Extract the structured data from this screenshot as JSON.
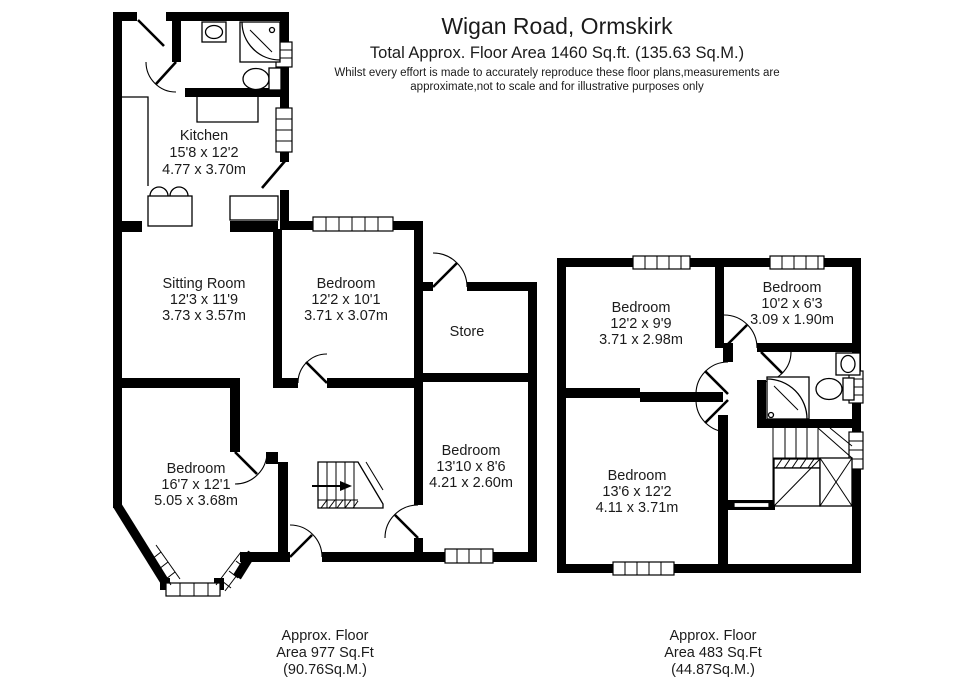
{
  "header": {
    "title": "Wigan Road, Ormskirk",
    "subtitle": "Total Approx. Floor Area 1460 Sq.ft. (135.63 Sq.M.)",
    "disclaimer_line1": "Whilst every effort is made to accurately reproduce these floor plans,measurements are",
    "disclaimer_line2": "approximate,not to scale and for illustrative purposes only"
  },
  "ground_floor": {
    "rooms": {
      "kitchen": {
        "name": "Kitchen",
        "imperial": "15'8 x 12'2",
        "metric": "4.77 x 3.70m"
      },
      "sitting_room": {
        "name": "Sitting Room",
        "imperial": "12'3 x 11'9",
        "metric": "3.73 x 3.57m"
      },
      "bedroom1": {
        "name": "Bedroom",
        "imperial": "12'2 x 10'1",
        "metric": "3.71 x 3.07m"
      },
      "store": {
        "name": "Store"
      },
      "bedroom2": {
        "name": "Bedroom",
        "imperial": "16'7 x 12'1",
        "metric": "5.05 x 3.68m"
      },
      "bedroom3": {
        "name": "Bedroom",
        "imperial": "13'10 x 8'6",
        "metric": "4.21 x 2.60m"
      }
    },
    "fixtures": [
      "wash-basin",
      "shower",
      "toilet",
      "kitchen-sink",
      "staircase-with-up-arrow",
      "bay-window"
    ],
    "area_label": {
      "line1": "Approx. Floor",
      "line2": "Area 977 Sq.Ft",
      "line3": "(90.76Sq.M.)"
    }
  },
  "first_floor": {
    "rooms": {
      "bedroom1": {
        "name": "Bedroom",
        "imperial": "12'2 x 9'9",
        "metric": "3.71 x 2.98m"
      },
      "bedroom2": {
        "name": "Bedroom",
        "imperial": "10'2 x 6'3",
        "metric": "3.09 x 1.90m"
      },
      "bedroom3": {
        "name": "Bedroom",
        "imperial": "13'6 x 12'2",
        "metric": "4.11 x 3.71m"
      }
    },
    "fixtures": [
      "wash-basin",
      "shower",
      "toilet",
      "winder-staircase"
    ],
    "area_label": {
      "line1": "Approx. Floor",
      "line2": "Area 483 Sq.Ft",
      "line3": "(44.87Sq.M.)"
    }
  },
  "colors": {
    "wall": "#000000",
    "text": "#1b1b1b",
    "background": "#ffffff"
  }
}
